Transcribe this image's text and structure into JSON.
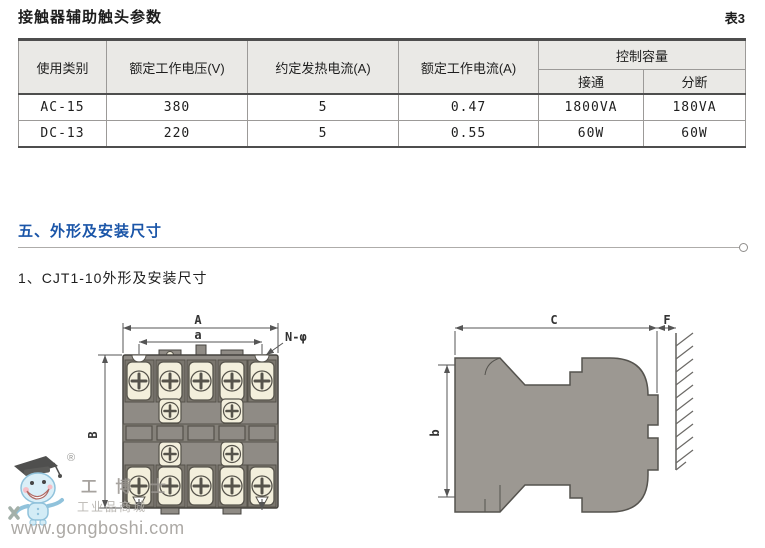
{
  "header": {
    "title": "接触器辅助触头参数",
    "table_tag": "表3"
  },
  "table": {
    "headers": [
      "使用类别",
      "额定工作电压(V)",
      "约定发热电流(A)",
      "额定工作电流(A)",
      "控制容量"
    ],
    "sub_headers": [
      "接通",
      "分断"
    ],
    "rows": [
      [
        "AC-15",
        "380",
        "5",
        "0.47",
        "1800VA",
        "180VA"
      ],
      [
        "DC-13",
        "220",
        "5",
        "0.55",
        "60W",
        "60W"
      ]
    ]
  },
  "sections": {
    "outline_heading": "五、外形及安装尺寸",
    "subsection": "1、CJT1-10外形及安装尺寸"
  },
  "diagram": {
    "front": {
      "dim_width_outer": "A",
      "dim_width_inner": "a",
      "dim_height": "B",
      "hole_callout": "N-φ"
    },
    "side": {
      "dim_depth": "C",
      "dim_clearance": "F",
      "dim_height": "b"
    }
  },
  "watermark": {
    "registered": "®",
    "brand": "工 博 士",
    "tagline": "工业品商城",
    "url": "www.gongboshi.com"
  },
  "colors": {
    "accent_blue": "#1a55a8",
    "body_gray": "#928e88",
    "terminal_cream": "#f3efdc",
    "header_bg": "#eae9e6"
  }
}
